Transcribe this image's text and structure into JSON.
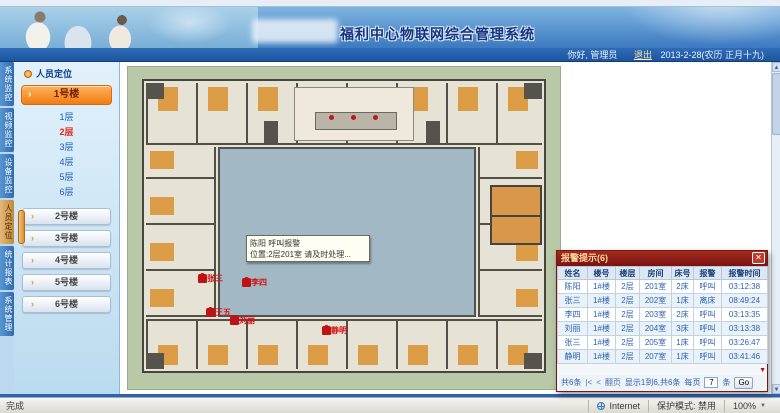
{
  "header": {
    "top_title": "福利中心物联网综合管理系统",
    "greeting": "你好, 管理员",
    "logout_label": "退出",
    "date_text": "2013-2-28(农历 正月十九)"
  },
  "nav_tabs": [
    {
      "label": "系统监控",
      "active": false
    },
    {
      "label": "视频监控",
      "active": false
    },
    {
      "label": "设备监控",
      "active": false
    },
    {
      "label": "人员定位",
      "active": true
    },
    {
      "label": "统计报表",
      "active": false
    },
    {
      "label": "系统管理",
      "active": false
    }
  ],
  "sidebar": {
    "panel_title": "人员定位",
    "building_current": "1号楼",
    "floors": [
      {
        "label": "1层",
        "active": false
      },
      {
        "label": "2层",
        "active": true
      },
      {
        "label": "3层",
        "active": false
      },
      {
        "label": "4层",
        "active": false
      },
      {
        "label": "5层",
        "active": false
      },
      {
        "label": "6层",
        "active": false
      }
    ],
    "buildings": [
      "2号楼",
      "3号楼",
      "4号楼",
      "5号楼",
      "6号楼"
    ]
  },
  "plan": {
    "tooltip": {
      "line1": "陈阳 呼叫报警",
      "line2": "位置:2层201室 请及时处理..."
    },
    "markers": [
      {
        "name": "张三",
        "x": 72,
        "y": 206
      },
      {
        "name": "李四",
        "x": 116,
        "y": 210
      },
      {
        "name": "王五",
        "x": 80,
        "y": 240
      },
      {
        "name": "刘丽",
        "x": 104,
        "y": 248
      },
      {
        "name": "静明",
        "x": 196,
        "y": 258
      }
    ]
  },
  "alarm_popup": {
    "title": "报警提示(6)",
    "close_icon": "✕",
    "columns": [
      "姓名",
      "楼号",
      "楼层",
      "房间",
      "床号",
      "报警",
      "报警时间"
    ],
    "rows": [
      [
        "陈阳",
        "1#楼",
        "2层",
        "201室",
        "2床",
        "呼叫",
        "03:12:38"
      ],
      [
        "张三",
        "1#楼",
        "2层",
        "202室",
        "1床",
        "离床",
        "08:49:24"
      ],
      [
        "李四",
        "1#楼",
        "2层",
        "203室",
        "2床",
        "呼叫",
        "03:13:35"
      ],
      [
        "刘丽",
        "1#楼",
        "2层",
        "204室",
        "3床",
        "呼叫",
        "03:13:38"
      ],
      [
        "张三",
        "1#楼",
        "2层",
        "205室",
        "1床",
        "呼叫",
        "03:26:47"
      ],
      [
        "静明",
        "1#楼",
        "2层",
        "207室",
        "1床",
        "呼叫",
        "03:41:46"
      ]
    ],
    "pager": {
      "count": "共6条",
      "first": "|<",
      "prev": "<",
      "page_label": "翻页",
      "info": "显示1到6,共6条",
      "per_label": "每页",
      "per_value": "7",
      "per_unit": "条",
      "go_label": "Go"
    }
  },
  "statusbar": {
    "left_text": "完成",
    "zone": "Internet",
    "protected_mode": "保护模式: 禁用",
    "zoom_level": "100%"
  },
  "icons": {
    "up": "▲",
    "down": "▼",
    "arrow": "›"
  }
}
